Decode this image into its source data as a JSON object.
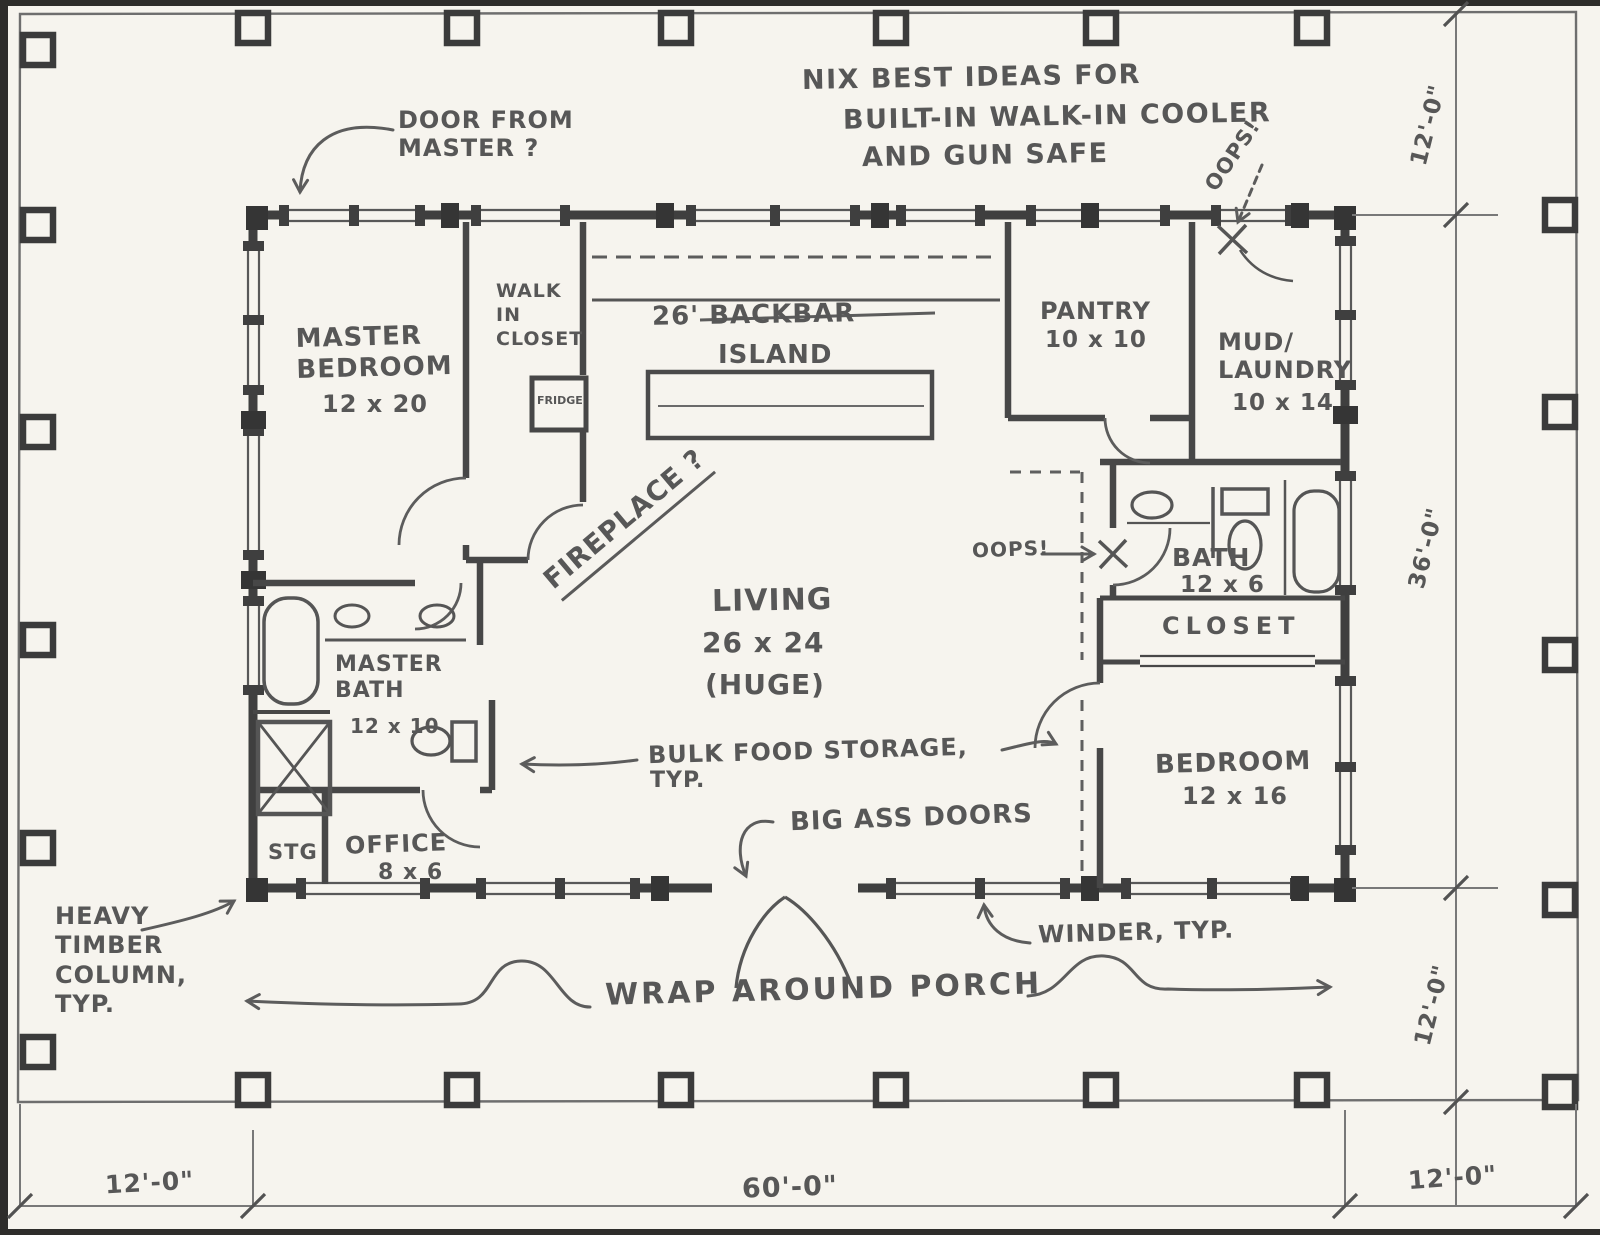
{
  "sheet": {
    "kind": "hand-drawn floor plan sketch"
  },
  "notes": {
    "nix_line1": "NIX BEST IDEAS FOR",
    "nix_line2": "BUILT-IN WALK-IN COOLER",
    "nix_line3": "AND GUN SAFE",
    "door_from_master": "DOOR FROM\nMASTER ?",
    "oops_top": "OOPS!",
    "oops_bath": "OOPS!",
    "fireplace": "FIREPLACE ?",
    "bulk_food_line1": "BULK FOOD STORAGE,",
    "bulk_food_line2": "TYP.",
    "big_ass_doors": "BIG ASS DOORS",
    "winder": "WINDER, TYP.",
    "heavy_timber": "HEAVY\nTIMBER\nCOLUMN,\nTYP.",
    "wrap_porch": "WRAP AROUND PORCH"
  },
  "rooms": {
    "master_bedroom": {
      "name": "MASTER\nBEDROOM",
      "size": "12 x 20"
    },
    "walk_in_closet": {
      "name": "WALK\nIN\nCLOSET"
    },
    "fridge": {
      "name": "FRIDGE"
    },
    "backbar": {
      "line1": "26' BACKBAR",
      "line2": "ISLAND"
    },
    "pantry": {
      "name": "PANTRY",
      "size": "10 x 10"
    },
    "mud_laundry": {
      "name": "MUD/\nLAUNDRY",
      "size": "10 x 14"
    },
    "living": {
      "name": "LIVING",
      "size": "26 x 24",
      "note": "(HUGE)"
    },
    "bath": {
      "name": "BATH",
      "size": "12 x 6"
    },
    "closet": {
      "name": "CLOSET"
    },
    "bedroom": {
      "name": "BEDROOM",
      "size": "12 x 16"
    },
    "master_bath": {
      "name": "MASTER\nBATH",
      "size": "12 x 10"
    },
    "stg": {
      "name": "STG"
    },
    "office": {
      "name": "OFFICE",
      "size": "8 x 6"
    }
  },
  "dimensions": {
    "right_top": "12'-0\"",
    "right_middle": "36'-0\"",
    "right_bottom": "12'-0\"",
    "bottom_left": "12'-0\"",
    "bottom_center": "60'-0\"",
    "bottom_right": "12'-0\""
  },
  "colors": {
    "paper": "#f6f4ee",
    "wall_ink": "#3f3f3f",
    "sketch_ink": "#5c5c5c",
    "text_ink": "#575757"
  }
}
